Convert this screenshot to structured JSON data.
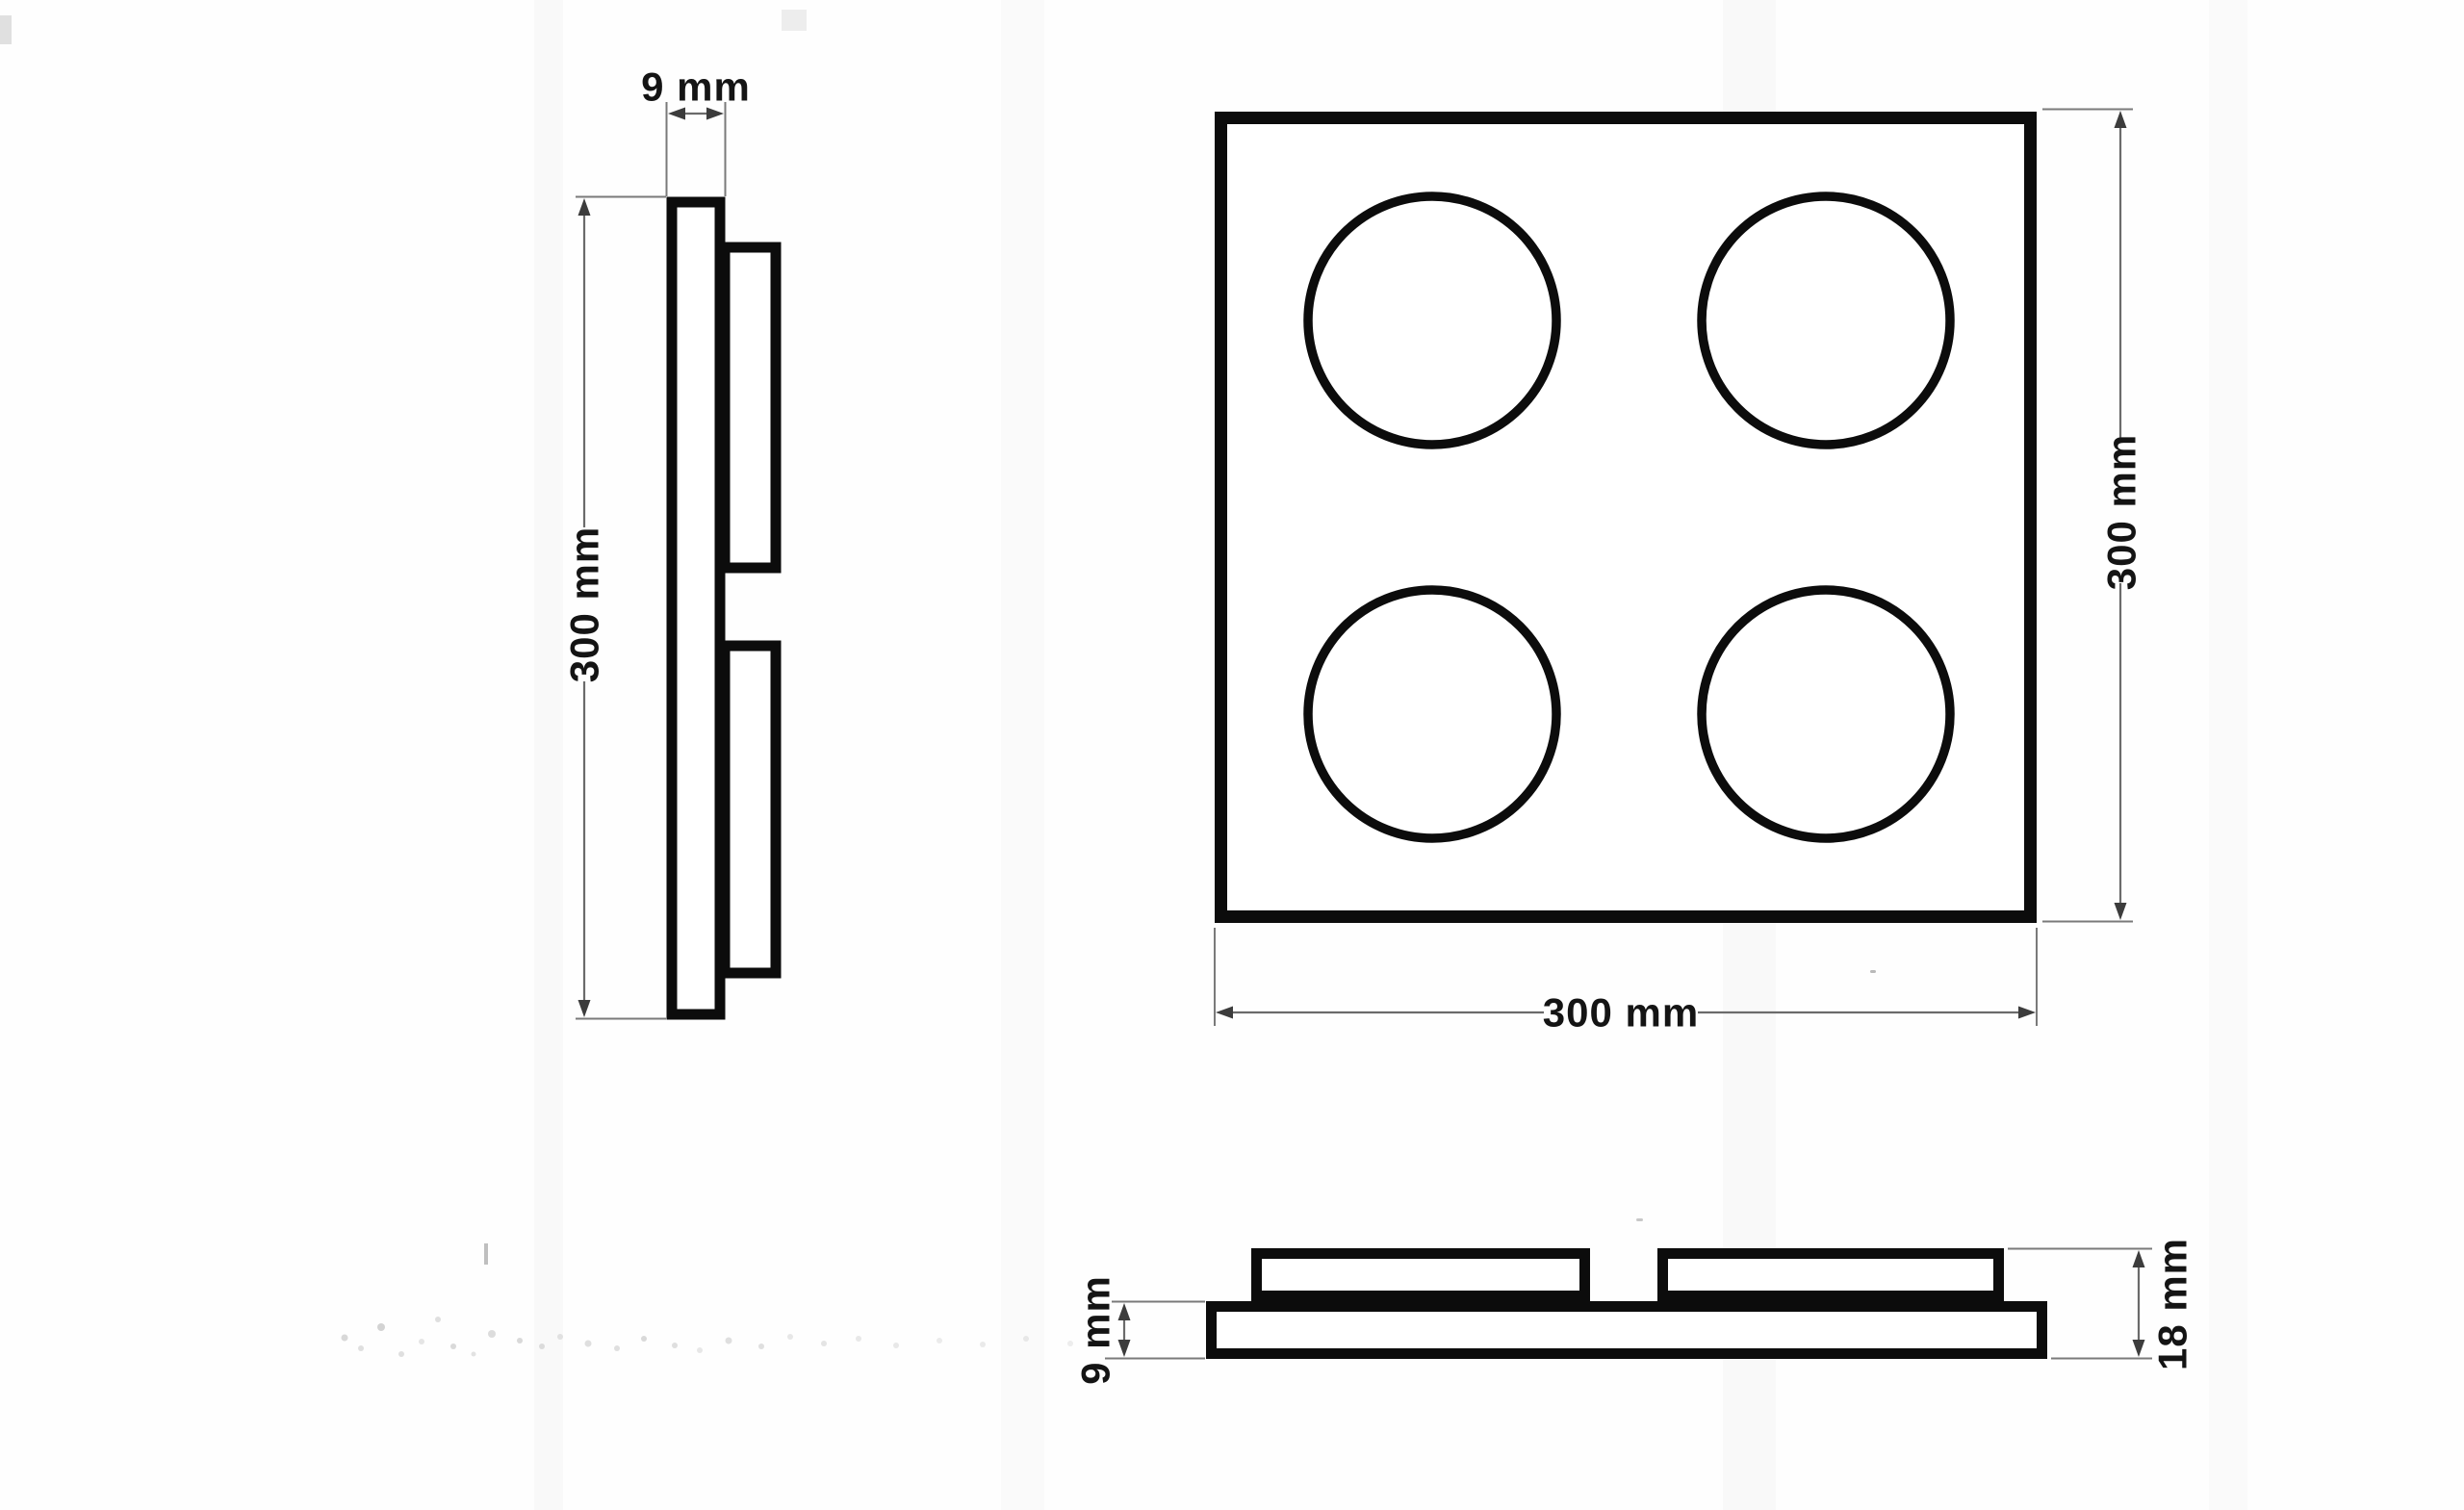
{
  "meta": {
    "kind": "technical dimension drawing",
    "views": [
      "side profile",
      "front face",
      "bottom profile"
    ],
    "background": "#fefefe"
  },
  "palette": {
    "outline": "#0c0c0c",
    "dimension_line": "#6b6b6b",
    "extension_line": "#7a7a7a",
    "arrow": "#3c3c3c",
    "text": "#141414"
  },
  "part": {
    "description": "square panel, 4 round pads on face, two raised battens on back",
    "front_width_mm": 300,
    "front_height_mm": 300,
    "base_thickness_mm": 9,
    "pad_thickness_mm": 9,
    "total_thickness_mm": 18,
    "circle_count": 4
  },
  "labels": {
    "side_thickness": "9 mm",
    "side_height": "300 mm",
    "front_height": "300 mm",
    "front_width": "300 mm",
    "bottom_base_thickness": "9 mm",
    "bottom_total_thickness": "18 mm"
  }
}
